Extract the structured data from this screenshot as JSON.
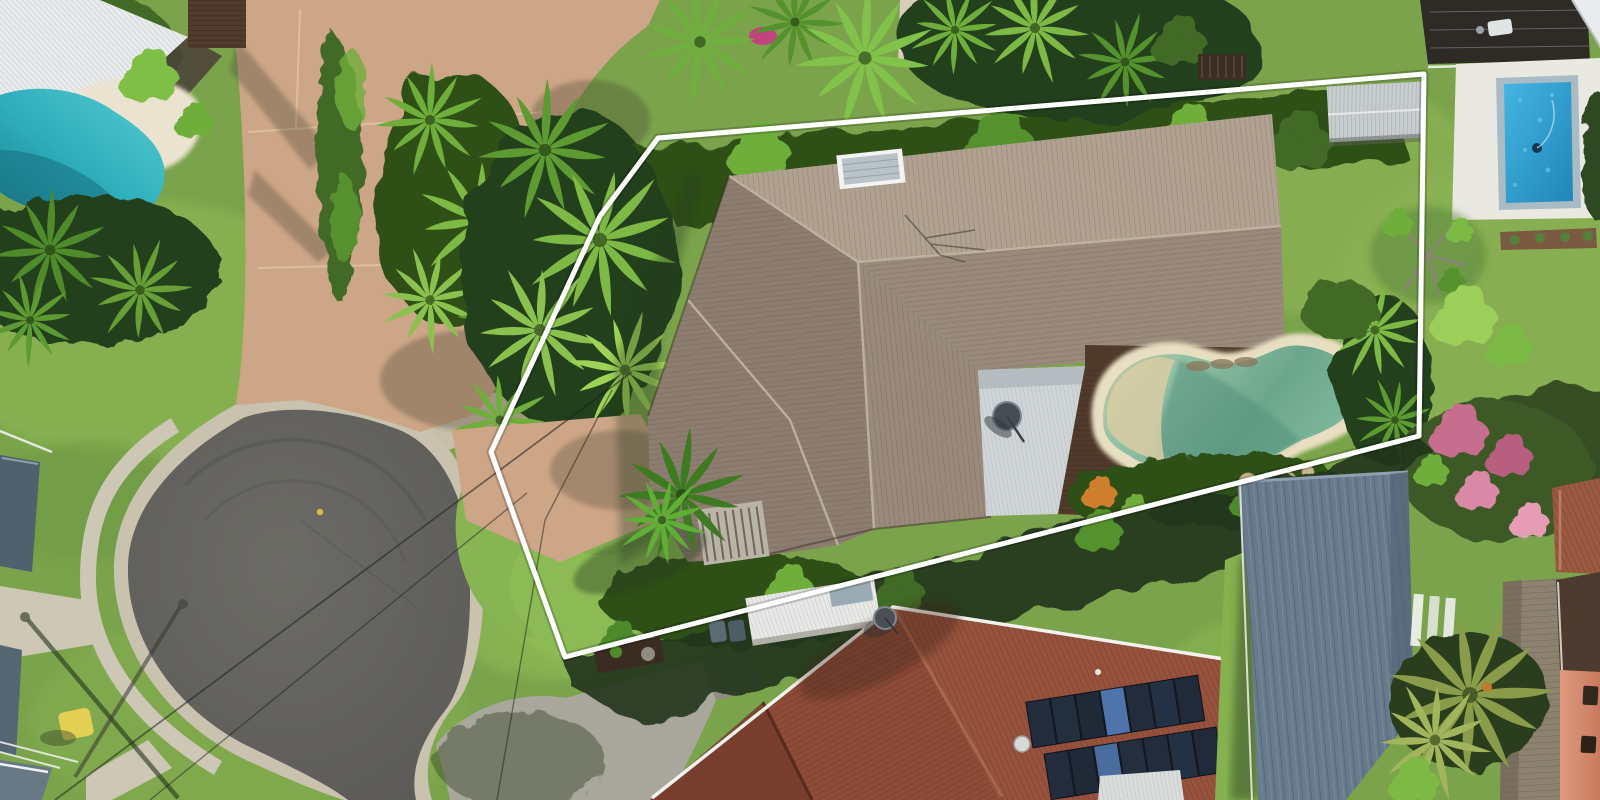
{
  "title": "Aerial drone photograph of a residential property with white boundary outline",
  "boundary": {
    "color": "#ffffff",
    "vertices": [
      [
        658,
        138
      ],
      [
        1424,
        74
      ],
      [
        1419,
        436
      ],
      [
        565,
        657
      ],
      [
        491,
        452
      ],
      [
        600,
        216
      ]
    ]
  },
  "scene_objects": {
    "main_house": "large hip-roof house with grey-tan tile roof and skylight",
    "main_pool": "kidney-shaped green pool with sandstone coping and timber deck",
    "cul_de_sac": "asphalt cul-de-sac turning circle with concrete kerb and footpaths",
    "top_left_pool": "turquoise free-form pool beside white corrugated roof",
    "top_right_pool": "rectangular bright blue pool with glass fence and white paving",
    "red_roof_house": "terracotta tiled house with two rows of solar panels and satellite dish",
    "blue_roof_house": "slate-blue metal roof house",
    "orange_wall_house": "salmon rendered wall with dark windows and dark brown tile roof",
    "vegetation": "tropical palms, hedges, pink flowering tree, lawns"
  },
  "palette": {
    "grass": "#7aa34b",
    "grassBright": "#8fbc55",
    "grassDark": "#55813a",
    "lawnNeighbor": "#8bb254",
    "vegDark": "#24401d",
    "vegMid": "#3f6b28",
    "vegBright": "#6fae3b",
    "vegLight": "#8cc24d",
    "palmBright": "#8bc24f",
    "asphalt": "#63625e",
    "kerb": "#c8c2af",
    "path": "#cdc7b5",
    "concrete": "#a9a79c",
    "concreteShade": "#8e8b80",
    "driveTan": "#cda687",
    "roofMain": "#b1a190",
    "roofMainShade": "#9a8a7b",
    "roofMainDark": "#8d7d70",
    "roofWhite": "#e9ebec",
    "roofShed": "#c7ccce",
    "roofRed": "#8e4c38",
    "roofRedDark": "#753c2c",
    "roofBlue": "#687b8d",
    "roofSlate": "#4f616d",
    "roofDarkBrown": "#4e3b30",
    "poolTurquoise": "#3fc0ca",
    "poolTurquoiseDeep": "#1d8b9e",
    "poolBeachTL": "#eae3d0",
    "poolGreen": "#84b89d",
    "poolGreenShade": "#5a937f",
    "poolBeach": "#d9cda5",
    "coping": "#e8dfc2",
    "poolBlue": "#2fa7d9",
    "poolBlueDeep": "#1f86b8",
    "poolPaving": "#e9e8e1",
    "poolCoping": "#a9bcc6",
    "deck": "#4f3a2b",
    "boardwalk": "#8d8170",
    "wallOrange": "#d4886b",
    "pink": "#c76e8e",
    "pinkLight": "#e59cb4",
    "carport": "#e8e9e6",
    "panelGrey": "#9aabb5",
    "solar": "#222c3c",
    "solarLight": "#4f74ab",
    "white": "#ffffff"
  }
}
